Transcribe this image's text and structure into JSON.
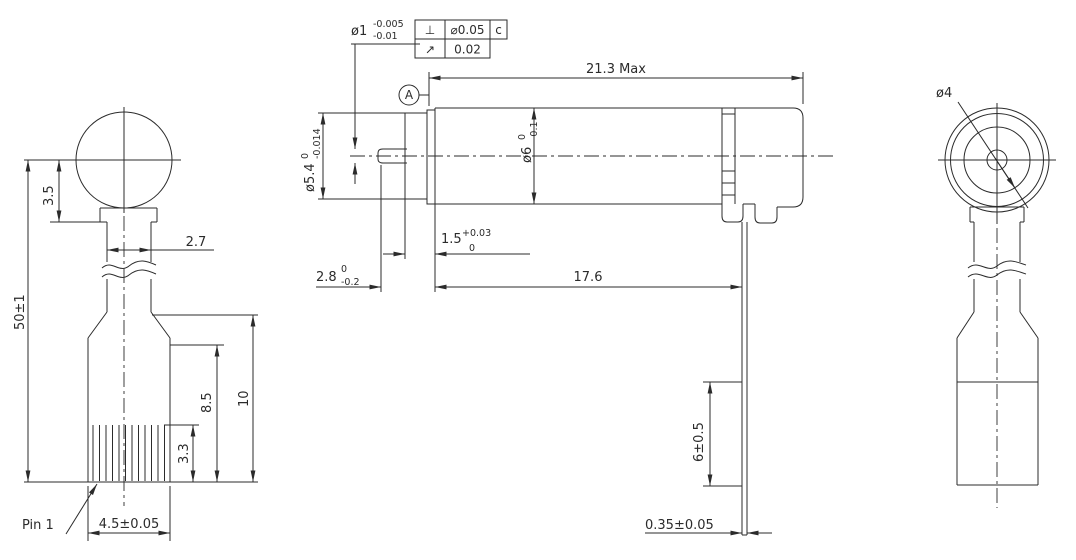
{
  "drawing": {
    "line_color": "#2b2b2b",
    "background": "#ffffff",
    "front_view": {
      "dim_overall_height": "50±1",
      "dim_head_center_to_neck": "3.5",
      "dim_ribbon_width": "2.7",
      "dim_connector_len_outer": "10",
      "dim_connector_len": "8.5",
      "dim_pin_len": "3.3",
      "dim_connector_width": "4.5±0.05",
      "pin1_label": "Pin 1"
    },
    "side_view": {
      "shaft_dia": {
        "value": "ø1",
        "tol_up": "-0.005",
        "tol_dn": "-0.01"
      },
      "gdt_perpendicularity": {
        "symbol": "⊥",
        "tolerance": "⌀0.05",
        "datum": "c"
      },
      "gdt_runout": {
        "symbol": "↗",
        "tolerance": "0.02"
      },
      "datum_label": "A",
      "dim_overall_length": "21.3 Max",
      "body_dia": {
        "value": "ø6",
        "tol_up": "0",
        "tol_dn": "-0.1"
      },
      "front_dia": {
        "value": "ø5.4",
        "tol_up": "0",
        "tol_dn": "-0.014"
      },
      "dim_bushing": {
        "value": "1.5",
        "tol_up": "+0.03",
        "tol_dn": "0"
      },
      "dim_shaft_ext": {
        "value": "2.8",
        "tol_up": "0",
        "tol_dn": "-0.2"
      },
      "dim_body_length": "17.6",
      "dim_fpc_drop": "6±0.5",
      "dim_fpc_thickness": "0.35±0.05"
    },
    "end_view": {
      "dim_bearing_dia": "ø4"
    }
  }
}
